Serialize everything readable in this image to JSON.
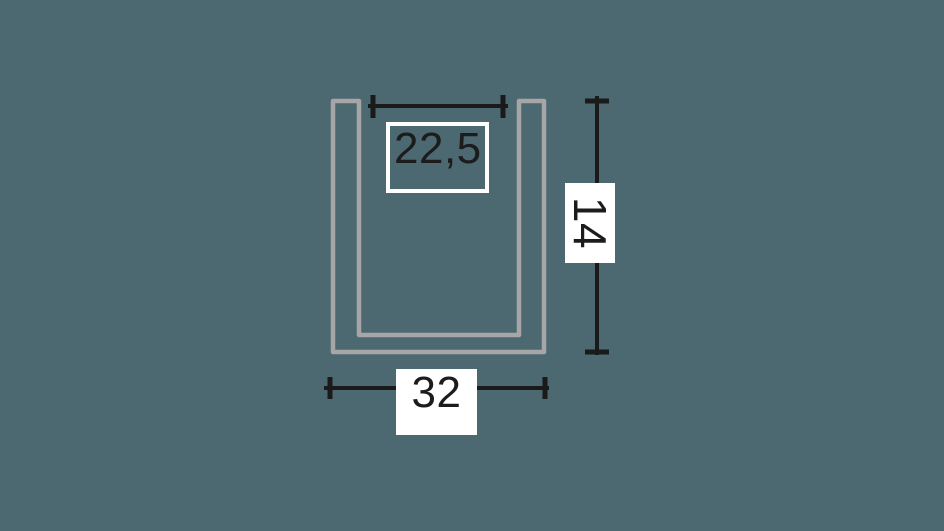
{
  "colors": {
    "background": "#4c6870",
    "profile_outline": "#a6a6a6",
    "dimension_line": "#1a1a1a",
    "label_box_fill": "#ffffff",
    "label_text": "#1c1c1c"
  },
  "diagram": {
    "description": "U-channel profile cross-section drawing with dimension annotations",
    "dimensions": [
      {
        "id": "inner-width",
        "value": "22,5",
        "orientation": "horizontal",
        "style": "outlined-box"
      },
      {
        "id": "height",
        "value": "14",
        "orientation": "vertical",
        "style": "filled-box-rotated"
      },
      {
        "id": "outer-width",
        "value": "32",
        "orientation": "horizontal",
        "style": "filled-box"
      }
    ]
  }
}
